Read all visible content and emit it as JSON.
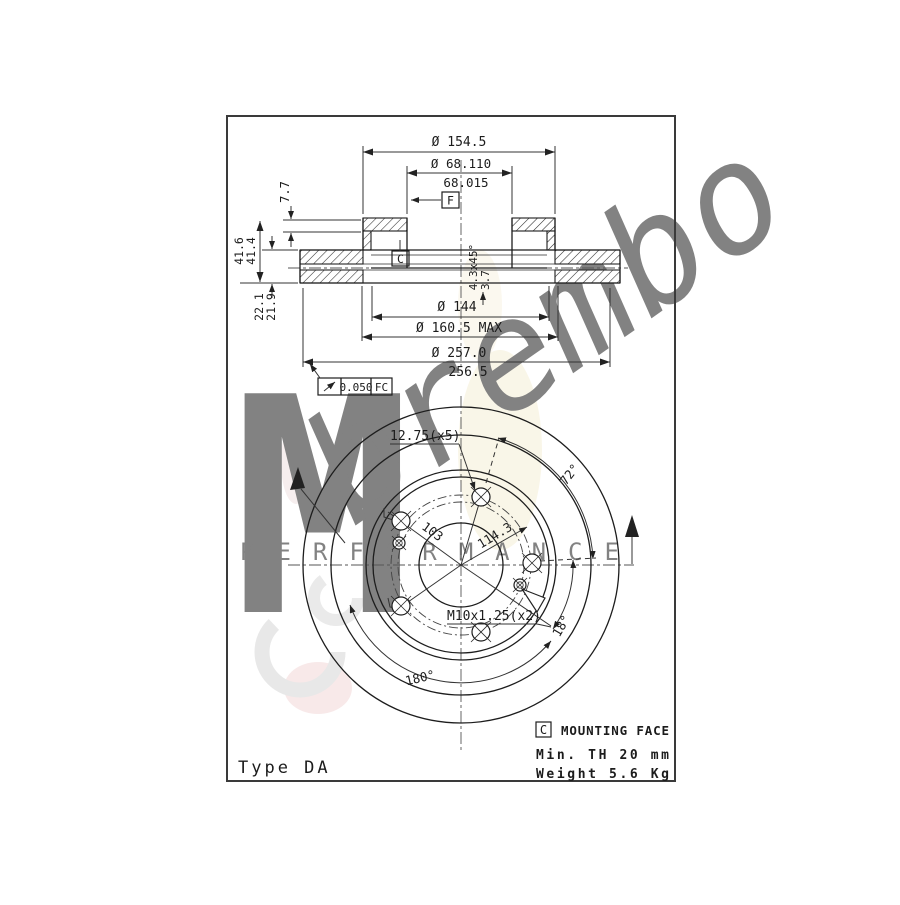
{
  "drawing": {
    "top_dims": {
      "hat_outer": "Ø 154.5",
      "bore_upper": "Ø 68.110",
      "bore_lower": "68.015"
    },
    "datums": {
      "f": "F",
      "c": "C"
    },
    "left_dims": {
      "offset": "7.7",
      "height_upper": "41.6",
      "height_lower": "41.4",
      "thickness_upper": "22.1",
      "thickness_lower": "21.9"
    },
    "mid_dims": {
      "chamfer": "4.3x45°",
      "step": "3.7",
      "inner": "Ø 144",
      "max": "Ø 160.5 MAX",
      "outer_upper": "Ø 257.0",
      "outer_lower": "256.5"
    },
    "runout": {
      "value": "0.050",
      "suffix": "FC"
    },
    "front_view": {
      "bolt_holes": "12.75(x5)",
      "pitch_angle": "72°",
      "pcd_small": "103",
      "pcd_large": "114.3",
      "thread": "M10x1.25(x2)",
      "thread_angle": "18°",
      "half_angle": "180°"
    },
    "notes": {
      "datum": "C",
      "mounting": "MOUNTING FACE",
      "min_th": "Min. TH 20 mm",
      "weight": "Weight 5.6 Kg",
      "type": "Type DA"
    },
    "watermark": {
      "monogram": "M",
      "brand": "brembo",
      "performance": "PERFORMANCE"
    }
  }
}
